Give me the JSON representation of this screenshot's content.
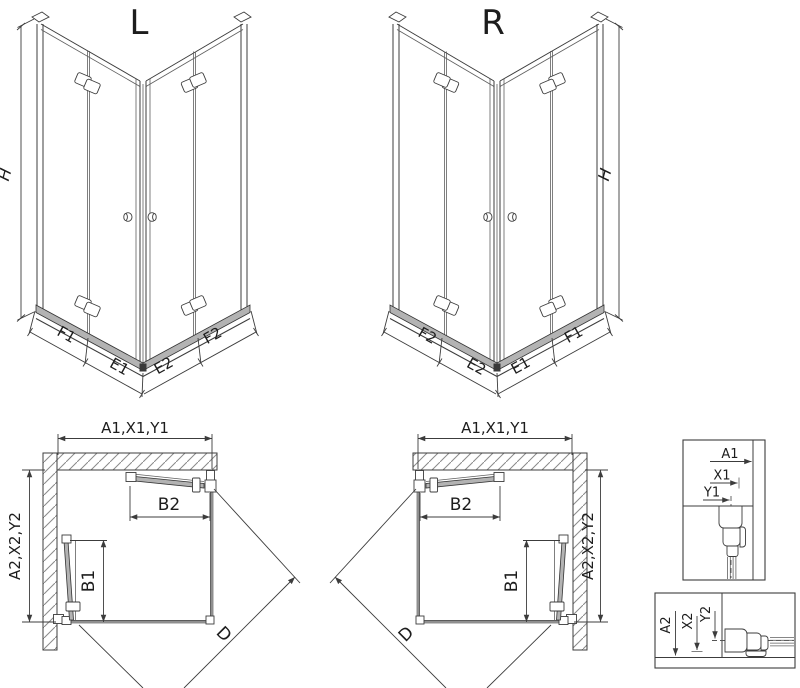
{
  "iso_l": {
    "title": "L",
    "height_label": "H",
    "segments": [
      "F1",
      "E1",
      "E2",
      "F2"
    ]
  },
  "iso_r": {
    "title": "R",
    "height_label": "H",
    "segments": [
      "F2",
      "E2",
      "E1",
      "F1"
    ]
  },
  "plan_l": {
    "width_dim": "A1,X1,Y1",
    "depth_dim": "A2,X2,Y2",
    "door_width_dim": "B2",
    "door_depth_dim": "B1",
    "diagonal_dim": "D"
  },
  "plan_r": {
    "width_dim": "A1,X1,Y1",
    "depth_dim": "A2,X2,Y2",
    "door_width_dim": "B2",
    "door_depth_dim": "B1",
    "diagonal_dim": "D"
  },
  "detail_top": {
    "labels": [
      "A1",
      "X1",
      "Y1"
    ]
  },
  "detail_bottom": {
    "labels": [
      "A2",
      "X2",
      "Y2"
    ]
  },
  "colors": {
    "line": "#3c3c3c",
    "glass": "#8f8f8f",
    "tray": "#b3b3b3",
    "background": "#ffffff"
  }
}
